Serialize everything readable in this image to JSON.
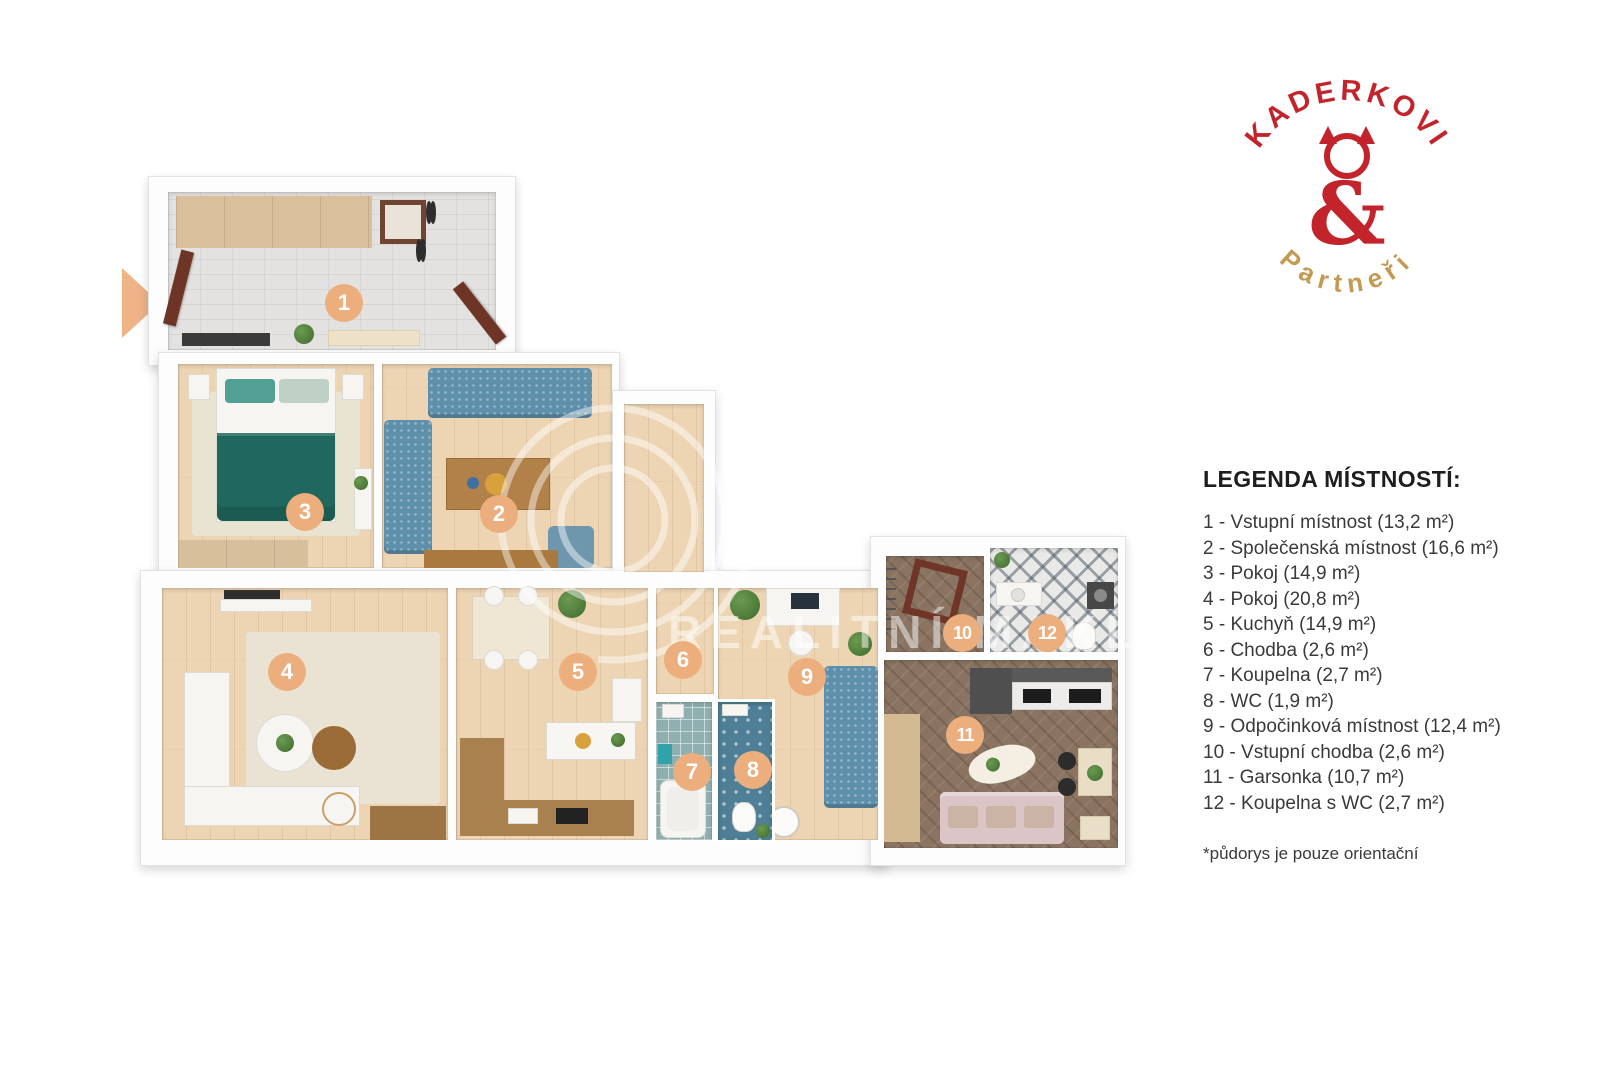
{
  "brand": {
    "name_top": "KADERKOVI",
    "amp": "&",
    "name_bottom": "Partneři",
    "color_red": "#C3232A",
    "color_gold": "#C49A52"
  },
  "legend": {
    "title": "LEGENDA MÍSTNOSTÍ:",
    "items": [
      "1 - Vstupní místnost (13,2 m²)",
      "2 - Společenská místnost (16,6 m²)",
      "3 - Pokoj (14,9 m²)",
      "4 - Pokoj (20,8 m²)",
      "5 - Kuchyň (14,9 m²)",
      "6 - Chodba (2,6 m²)",
      "7 - Koupelna (2,7 m²)",
      "8 - WC (1,9 m²)",
      "9 - Odpočinková místnost (12,4 m²)",
      "10 - Vstupní chodba (2,6 m²)",
      "11 - Garsonka (10,7 m²)",
      "12 - Koupelna s WC (2,7 m²)"
    ],
    "footnote": "*půdorys je pouze orientační"
  },
  "floorplan": {
    "badge_color": "#EDAE7E",
    "entrance_arrow_color": "#EFB387",
    "badges": [
      {
        "num": "1",
        "x": 224,
        "y": 143
      },
      {
        "num": "2",
        "x": 379,
        "y": 354
      },
      {
        "num": "3",
        "x": 185,
        "y": 352
      },
      {
        "num": "4",
        "x": 167,
        "y": 512
      },
      {
        "num": "5",
        "x": 458,
        "y": 512
      },
      {
        "num": "6",
        "x": 563,
        "y": 500
      },
      {
        "num": "7",
        "x": 572,
        "y": 612
      },
      {
        "num": "8",
        "x": 633,
        "y": 610
      },
      {
        "num": "9",
        "x": 687,
        "y": 517
      },
      {
        "num": "10",
        "x": 842,
        "y": 473
      },
      {
        "num": "11",
        "x": 845,
        "y": 575
      },
      {
        "num": "12",
        "x": 927,
        "y": 473
      }
    ]
  },
  "watermark": {
    "text": "REALITNÍ MAKLÉŘI"
  }
}
